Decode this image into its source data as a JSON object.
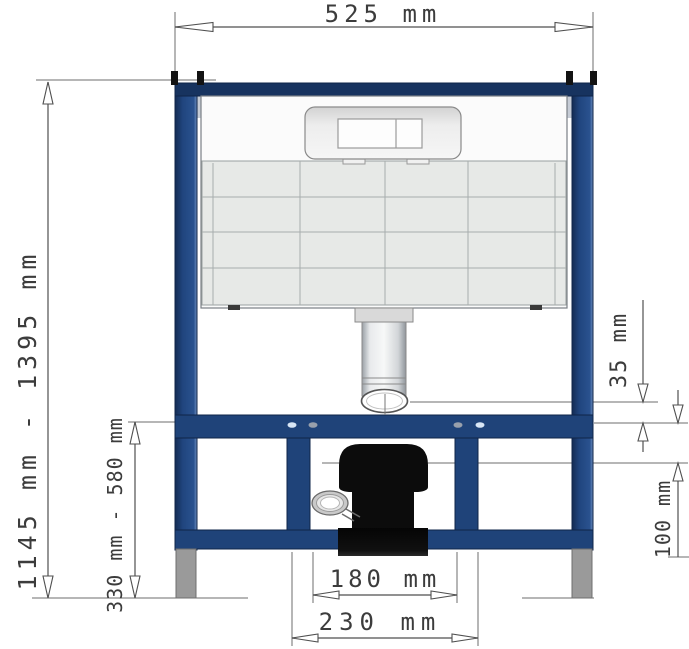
{
  "dims": {
    "width_top": "525 mm",
    "height_overall": "1145 mm - 1395 mm",
    "height_lower_frame": "330 mm - 580 mm",
    "flush_bend_offset": "35 mm",
    "outlet_offset": "100 mm",
    "outlet_width_inner": "180 mm",
    "outlet_width_outer": "230 mm"
  },
  "colors": {
    "frame_blue": "#1f4379",
    "frame_blue_dark": "#17335f",
    "frame_outline": "#0f2448",
    "cistern_panel": "#e7e9e7",
    "cistern_top": "#fbfbfb",
    "flush_plate": "#e2e2e2",
    "outlet_black": "#0c0c0c",
    "foot_gray": "#9a9a9a",
    "dimension_line": "#4f4f4f",
    "background": "#ffffff"
  }
}
